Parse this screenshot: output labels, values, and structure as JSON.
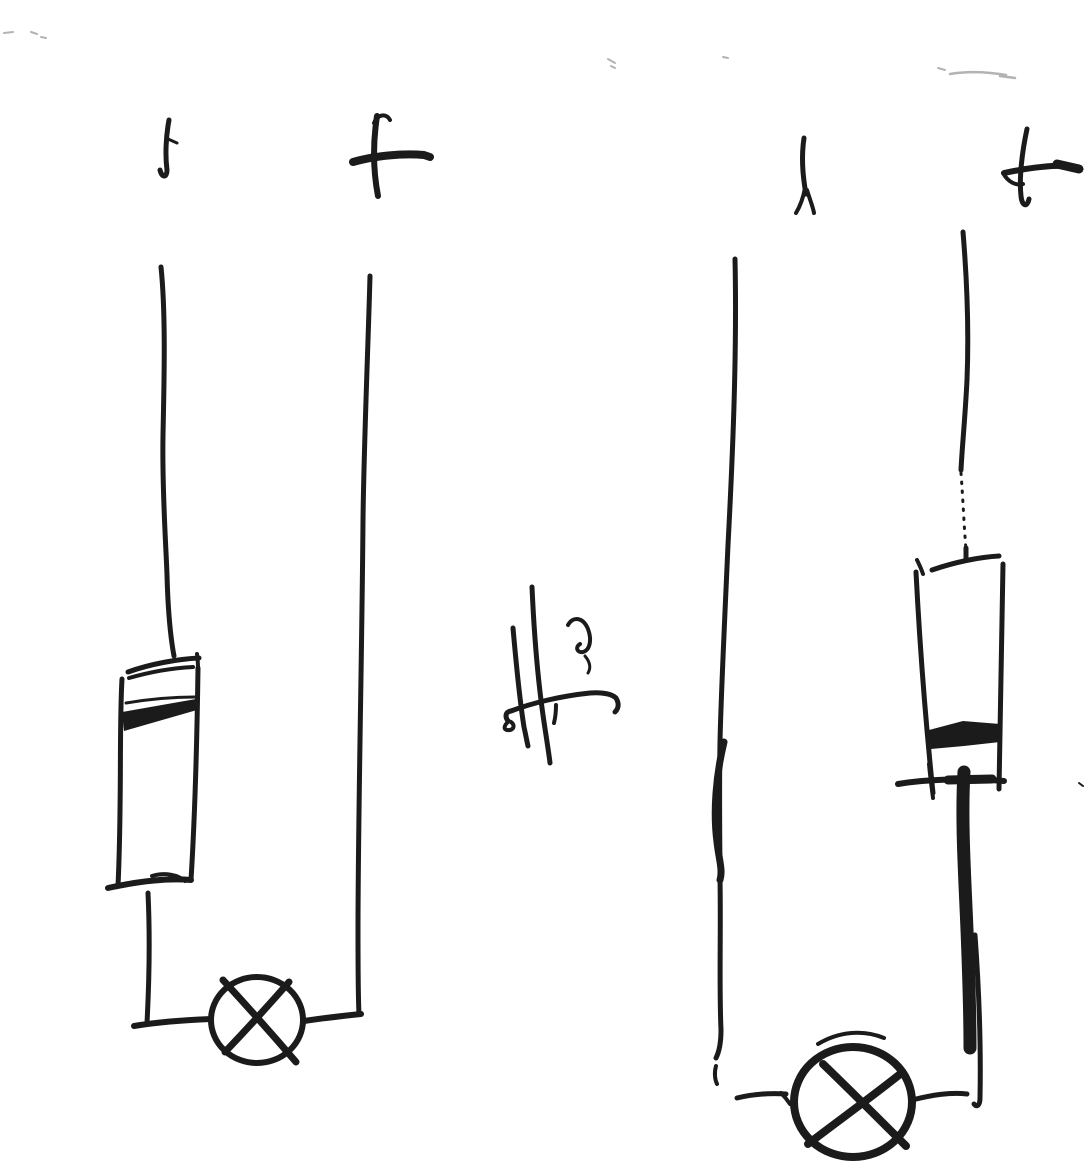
{
  "sketch": {
    "background_color": "#ffffff",
    "ink_color": "#1b1b1b",
    "faint_mark_color": "#b3b3b3",
    "kind": "hand-drawn two-circuit sketch"
  },
  "annotation": {
    "text": "He"
  },
  "circuits": [
    {
      "name": "left circuit",
      "terminals": {
        "negative": "−",
        "positive": "+"
      },
      "components": {
        "cell": "banded cell (rectangle with dark band near top)",
        "lamp": "lamp (circle with cross)"
      }
    },
    {
      "name": "right circuit",
      "terminals": {
        "negative": "−",
        "positive": "+"
      },
      "components": {
        "cell": "banded cell (rectangle with dark band near bottom)",
        "lamp": "lamp (circle with cross)"
      }
    }
  ]
}
